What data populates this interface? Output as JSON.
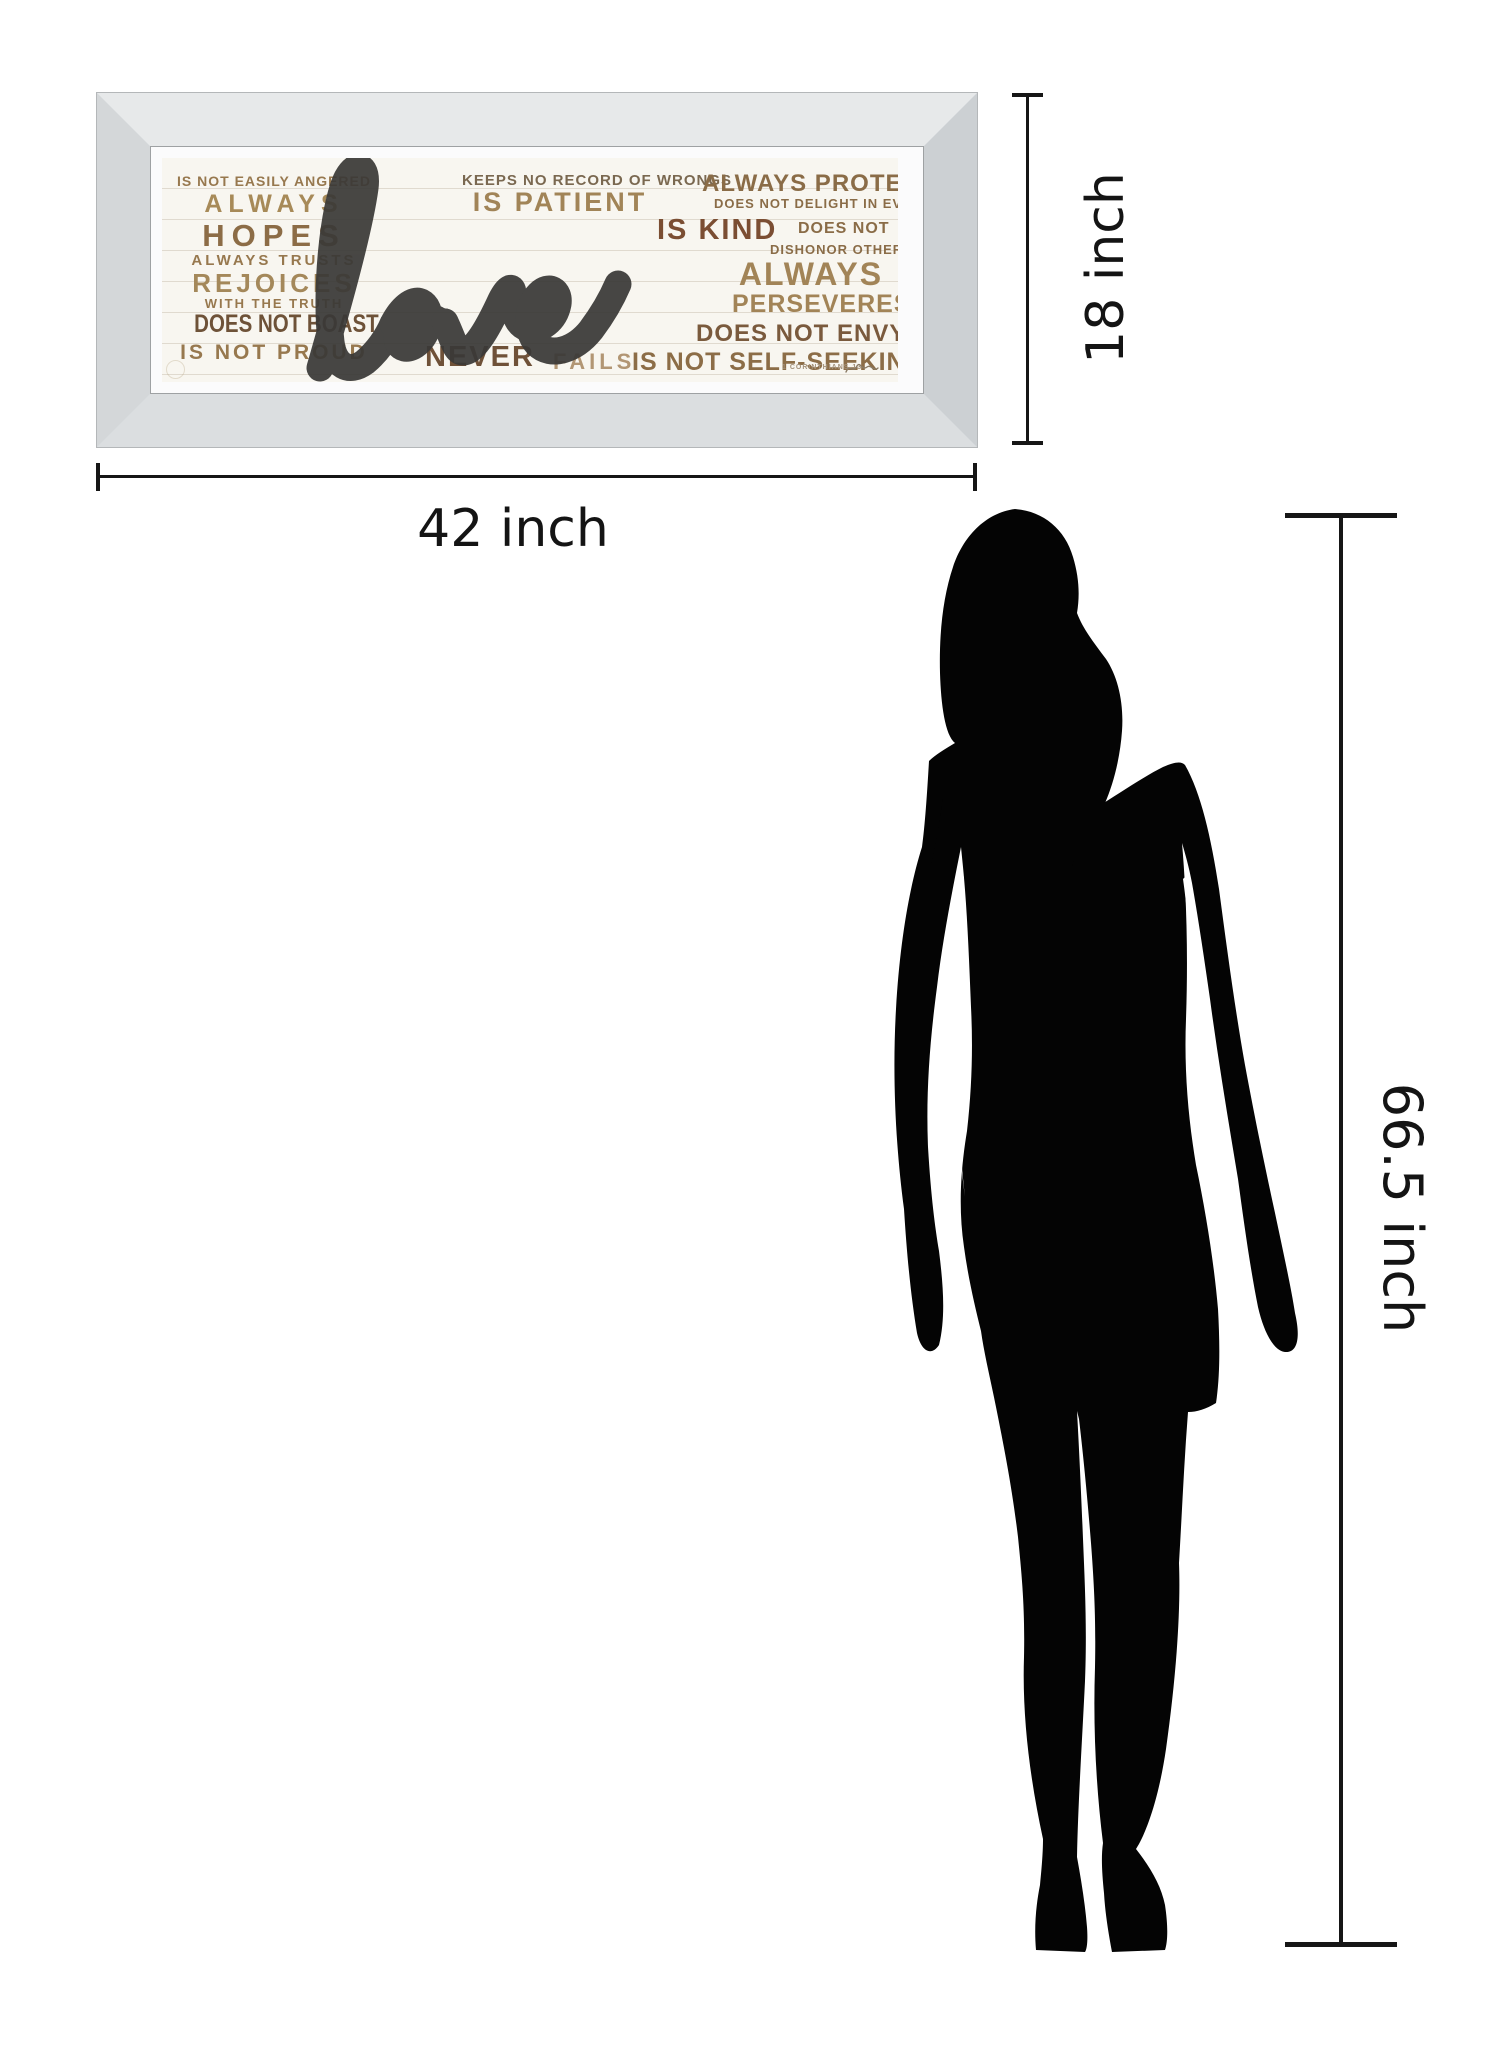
{
  "artwork": {
    "main_word": "love",
    "left_column": [
      "IS NOT EASILY ANGERED",
      "ALWAYS",
      "HOPES",
      "ALWAYS TRUSTS",
      "REJOICES",
      "WITH THE TRUTH",
      "DOES NOT BOAST",
      "IS NOT PROUD"
    ],
    "center_top": [
      "KEEPS NO RECORD OF WRONGS",
      "IS PATIENT"
    ],
    "center_bottom": [
      "NEVER",
      "FAILS"
    ],
    "right_column": [
      "ALWAYS PROTECTS",
      "DOES NOT DELIGHT IN EVIL",
      "IS KIND",
      "DOES NOT",
      "DISHONOR OTHERS",
      "ALWAYS",
      "PERSEVERES",
      "DOES NOT ENVY",
      "IS NOT SELF-SEEKING"
    ],
    "signature": "1 CORINTHIANS 13",
    "palette": {
      "art_background": "#f8f6f0",
      "plank_line": "#e0dacf",
      "script_word": "#3a3937",
      "gold_dark": "#6e5238",
      "gold_mid": "#8c6c46",
      "gold_light": "#a78a58",
      "gold_pale": "#b29674",
      "rust": "#7b4e33",
      "frame_bevel_light": "#e7e9ea",
      "frame_bevel_dark": "#ccd0d3"
    }
  },
  "dimensions": {
    "width_label": "42 inch",
    "height_label": "18 inch",
    "person_height_label": "66.5 inch",
    "line_color": "#161616"
  },
  "figure": {
    "name": "woman-silhouette",
    "color": "#040404"
  }
}
